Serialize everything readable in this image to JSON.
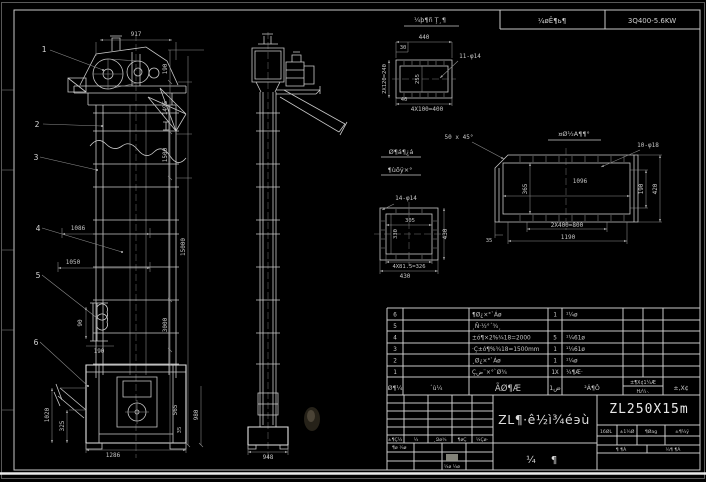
{
  "frame": {
    "header_cells": [
      "¼øÊ¶ь¶",
      "3Q400-5.6KW"
    ]
  },
  "balloons": [
    "1",
    "2",
    "3",
    "4",
    "5",
    "6"
  ],
  "dims": {
    "f917": "917",
    "f190": "190",
    "f1495": "1495",
    "f1500": "1500",
    "f3000": "3000",
    "f15000": "15000",
    "f565": "565",
    "f35": "35",
    "f980": "980",
    "f1086": "1086",
    "f1050": "1050",
    "f90": "90",
    "fb190": "190",
    "f1020": "1020",
    "f325": "325",
    "f1286": "1286",
    "s948": "948"
  },
  "detail_a": {
    "title": "¼þ¶ñ Ţ¸¶",
    "d440": "440",
    "d30": "30",
    "holes": "11-φ14",
    "d240": "2X120=240",
    "d255": "255",
    "d40": "40",
    "d400": "4X100=400"
  },
  "detail_b": {
    "title": "¤Ø½A¶¶°",
    "chamfer": "50 x 45°",
    "holes": "10-φ18",
    "d1096": "1096",
    "d365": "365",
    "d190": "190",
    "d420": "420",
    "d800": "2X400=800",
    "d1190": "1190",
    "d35": "35"
  },
  "detail_c": {
    "title1": "Ø¶á¶¿á",
    "title2": "¶ùõÿ×°",
    "holes": "14-φ14",
    "d305": "305",
    "d330": "330",
    "d430r": "430",
    "d326": "4X81.5=326",
    "d430b": "430"
  },
  "bom": {
    "header": [
      "Ø¶¼",
      "´ù¼",
      "ÃØ¶Æ",
      "ض1",
      "²Á¶Ô",
      "±¶X¢1¼Æ",
      "Ƕ¼·.",
      "±,X¢"
    ],
    "rows": [
      {
        "no": "6",
        "name": "¶Ø¿×°`Áø",
        "qty": "1",
        "mat": "¹¼ø"
      },
      {
        "no": "5",
        "name": "¸Ñ·½°´¾¸",
        "qty": "",
        "mat": ""
      },
      {
        "no": "4",
        "name": "±ó¶×2%¾18=2000",
        "qty": "5",
        "mat": "¹¼61ø"
      },
      {
        "no": "3",
        "name": "·Ç±ó¶%¾18=1500mm",
        "qty": "1",
        "mat": "¹¼61ø"
      },
      {
        "no": "2",
        "name": "¸Ø¿×°`Áø",
        "qty": "1",
        "mat": "¹¼ø"
      },
      {
        "no": "1",
        "name": "Çض¨×°`Ø¾",
        "qty": "1X",
        "mat": "¼¶Æ·"
      }
    ]
  },
  "title_block": {
    "title": "ZL¶·ê½ì¾é϶ù",
    "model": "ZL250X15m",
    "page_left": "¼",
    "page_right": "¶",
    "sig_header": [
      "±¶Ç¼",
      "¼",
      "¸Ձø¾",
      "¶øÇ",
      "¼Çø·"
    ],
    "sig_row1": "¶ø ¼ø",
    "sig_grey": "¼¶",
    "sig_row2": "¼ø ¼ø",
    "spec_cells": [
      "16ØL",
      "±1¼Ø",
      "¶Øag",
      "±¶¼ÿ"
    ],
    "scale_left": "¶ ¶Á",
    "scale_right": "¼¶ ¶Á"
  }
}
